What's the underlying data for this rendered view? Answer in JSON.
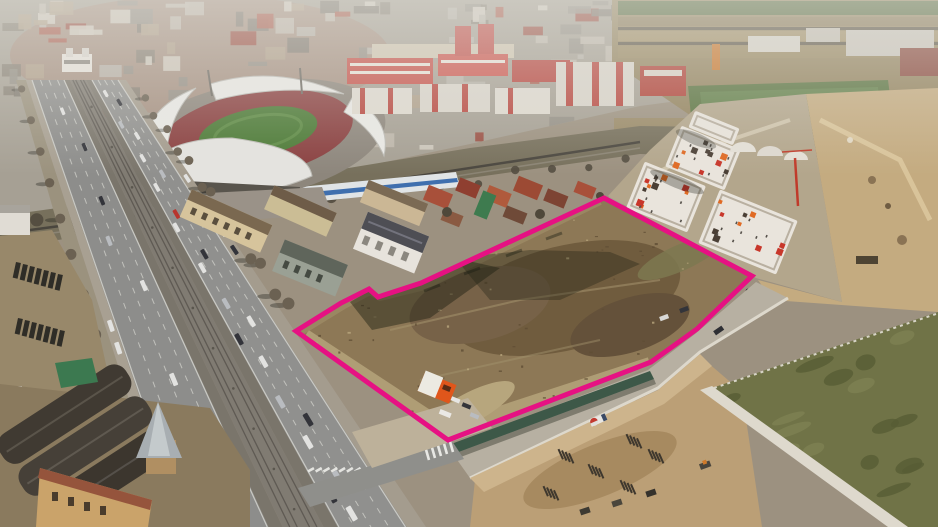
{
  "meta": {
    "type": "aerial-drone-photograph",
    "subject": "vacant development land parcel highlighted with a magenta boundary",
    "setting": "city-edge district with a wide boulevard, football stadium, socialist apartment blocks, new residential buildings and active construction sites",
    "no_visible_text": true
  },
  "parcel": {
    "label": "highlighted-land-parcel",
    "outline_color": "#e61183",
    "outline_width": 5,
    "surface": "bare brown earth with sandy tracks and building shadows"
  },
  "landmarks": {
    "stadium": "football stadium with white curved roofs, red stands and green pitch",
    "boulevard": "multi-lane boulevard with central tram tracks, trees and traffic",
    "old_factory": "historic factory with dark barrel-vault roofs and conical turret",
    "modern_apartments": "white apartment blocks with orange and red facade panels",
    "construction_site": "excavated foundations with concrete mixer truck",
    "green_field": "fenced sports field",
    "kiosk": "small orange roadside kiosk at parcel entrance"
  },
  "palette": {
    "parcel_dirt": "#8d7856",
    "pitch_green": "#4c7a36",
    "sports_field_green": "#5a7340",
    "grass_olive": "#707347",
    "asphalt": "#8d8d8b",
    "haze": "#e2e2dc",
    "construction_sand": "#bb9f76",
    "green_wall": "#3d5848",
    "kiosk_orange": "#e0561b"
  }
}
